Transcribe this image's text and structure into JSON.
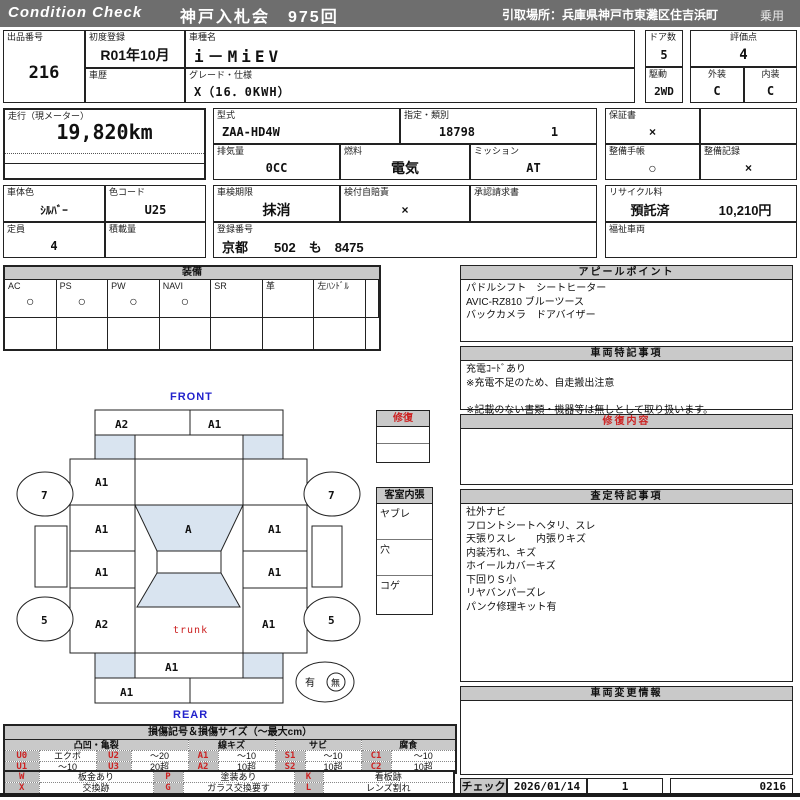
{
  "topbar": {
    "brand": "Condition  Check",
    "auction": "神戸入札会　975回",
    "pickup": "引取場所：兵庫県神戸市東灘区住吉浜町",
    "use_type": "乗用"
  },
  "info": {
    "lot_label": "出品番号",
    "lot": "216",
    "first_reg_label": "初度登録",
    "first_reg": "R01年10月",
    "history_label": "車歴",
    "history": "",
    "model_name_label": "車種名",
    "model_name": "i－MiEV",
    "grade_label": "グレード・仕様",
    "grade": "X（16．0KWH）",
    "doors_label": "ドア数",
    "doors": "5",
    "score_label": "評価点",
    "score": "4",
    "drive_label": "駆動",
    "drive": "2WD",
    "exterior_label": "外装",
    "exterior": "C",
    "interior_label": "内装",
    "interior": "C",
    "mileage_label": "走行（現メーター）",
    "mileage": "19,820km",
    "model_code_label": "型式",
    "model_code": "ZAA-HD4W",
    "class_label": "指定・類別",
    "class_no": "18798",
    "class_sub": "1",
    "warranty_label": "保証書",
    "warranty": "×",
    "displacement_label": "排気量",
    "displacement": "0CC",
    "fuel_label": "燃料",
    "fuel": "電気",
    "mission_label": "ミッション",
    "mission": "AT",
    "maint_book_label": "整備手帳",
    "maint_book": "○",
    "maint_record_label": "整備記録",
    "maint_record": "×",
    "color_label": "車体色",
    "color": "ｼﾙﾊﾞｰ",
    "color_code_label": "色コード",
    "color_code": "U25",
    "inspection_label": "車検期限",
    "inspection": "抹消",
    "insurance_label": "検付自賠責",
    "insurance": "×",
    "approval_label": "承認請求書",
    "approval": "",
    "recycle_label": "リサイクル料",
    "recycle_status": "預託済",
    "recycle_fee": "10,210円",
    "capacity_label": "定員",
    "capacity": "4",
    "load_label": "積載量",
    "load": "",
    "reg_no_label": "登録番号",
    "reg_no": "京都　　502　も　8475",
    "chassis_label": "車台番号",
    "chassis": "HD4W-0000323",
    "welfare_label": "福祉車両",
    "welfare": ""
  },
  "equipment": {
    "title": "装備",
    "items": [
      {
        "label": "AC",
        "value": "○"
      },
      {
        "label": "PS",
        "value": "○"
      },
      {
        "label": "PW",
        "value": "○"
      },
      {
        "label": "NAVI",
        "value": "○"
      },
      {
        "label": "SR",
        "value": ""
      },
      {
        "label": "革",
        "value": ""
      },
      {
        "label": "左ﾊﾝﾄﾞﾙ",
        "value": ""
      }
    ]
  },
  "appeal": {
    "title": "アピールポイント",
    "lines": [
      "パドルシフト　シートヒーター",
      "AVIC-RZ810 ブルーツース",
      "バックカメラ　ドアバイザー"
    ]
  },
  "vehicle_notes": {
    "title": "車両特記事項",
    "lines": [
      "充電ｺｰﾄﾞあり",
      "※充電不足のため、自走搬出注意",
      "",
      "※記載のない書類・機器等は無しとして取り扱います。"
    ]
  },
  "repair_detail": {
    "title": "修復内容",
    "lines": []
  },
  "assessment": {
    "title": "査定特記事項",
    "lines": [
      "社外ナビ",
      "フロントシートヘタリ、スレ",
      "天張りスレ　　内張りキズ",
      "内装汚れ、キズ",
      "ホイールカバーキズ",
      "下回りＳ小",
      "リヤバンパーズレ",
      "パンク修理キット有"
    ]
  },
  "change_info": {
    "title": "車両変更情報",
    "lines": []
  },
  "check": {
    "label": "チェック",
    "date": "2026/01/14",
    "count": "1",
    "code": "0216"
  },
  "repair_box": {
    "title": "修復"
  },
  "cabin_box": {
    "title": "客室内張",
    "items": [
      "ヤブレ",
      "穴",
      "コゲ"
    ]
  },
  "diagram": {
    "front_label": "FRONT",
    "rear_label": "REAR",
    "zones": {
      "front_bumper_left": "A2",
      "front_bumper_right": "A1",
      "left_fender": "A1",
      "left_front_door": "A1",
      "windshield": "A",
      "right_front_door": "A1",
      "left_rear_door": "A1",
      "right_rear_door": "A1",
      "left_quarter": "A2",
      "right_quarter": "A1",
      "trunk": "trunk",
      "rear_panel": "A1",
      "rear_bumper_left": "A1"
    },
    "wheels": {
      "front_left": "7",
      "front_right": "7",
      "rear_left": "5",
      "rear_right": "5"
    },
    "spare_presence": {
      "present": "有",
      "absent": "無"
    }
  },
  "legend": {
    "title": "損傷記号＆損傷サイズ（～最大cm）",
    "groups": [
      "凸凹・亀裂",
      "線キズ",
      "サビ",
      "腐食"
    ],
    "row1": [
      {
        "code": "U0",
        "desc": "エクボ"
      },
      {
        "code": "U2",
        "desc": "～20"
      },
      {
        "code": "A1",
        "desc": "～10"
      },
      {
        "code": "S1",
        "desc": "～10"
      },
      {
        "code": "C1",
        "desc": "～10"
      }
    ],
    "row2": [
      {
        "code": "U1",
        "desc": "～10"
      },
      {
        "code": "U3",
        "desc": "20超"
      },
      {
        "code": "A2",
        "desc": "10超"
      },
      {
        "code": "S2",
        "desc": "10超"
      },
      {
        "code": "C2",
        "desc": "10超"
      }
    ],
    "row3": [
      {
        "code": "W",
        "desc": "板金あり"
      },
      {
        "code": "P",
        "desc": "塗装あり"
      },
      {
        "code": "K",
        "desc": "看板跡"
      }
    ],
    "row4": [
      {
        "code": "X",
        "desc": "交換跡"
      },
      {
        "code": "G",
        "desc": "ガラス交換要す"
      },
      {
        "code": "L",
        "desc": "レンズ割れ"
      }
    ]
  }
}
